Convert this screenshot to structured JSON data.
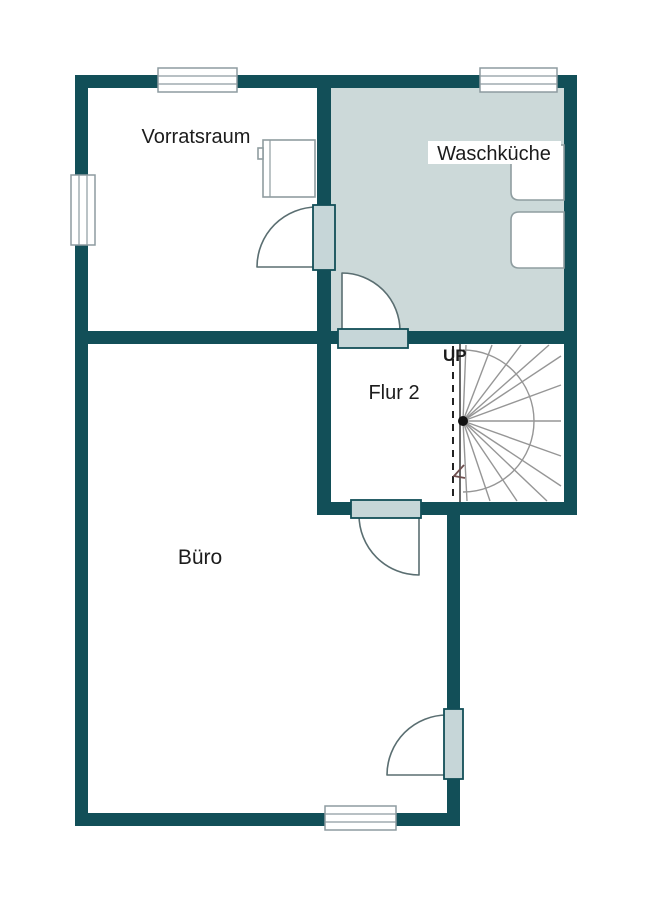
{
  "rooms": {
    "vorratsraum": {
      "label": "Vorratsraum"
    },
    "waschkueche": {
      "label": "Waschküche"
    },
    "flur2": {
      "label": "Flur 2"
    },
    "buero": {
      "label": "Büro"
    }
  },
  "stairs": {
    "up_label": "UP"
  },
  "colors": {
    "wall": "#124f58",
    "room_fill": "#ccd9d9",
    "door_leaf": "#c6d6d8",
    "window_frame": "#8d9ba0",
    "swing_stroke": "#5a6e71",
    "fixture_border": "#8f9da0",
    "stair_line": "#969696",
    "arrow": "#6e4f4f",
    "text": "#1c1c1c"
  }
}
